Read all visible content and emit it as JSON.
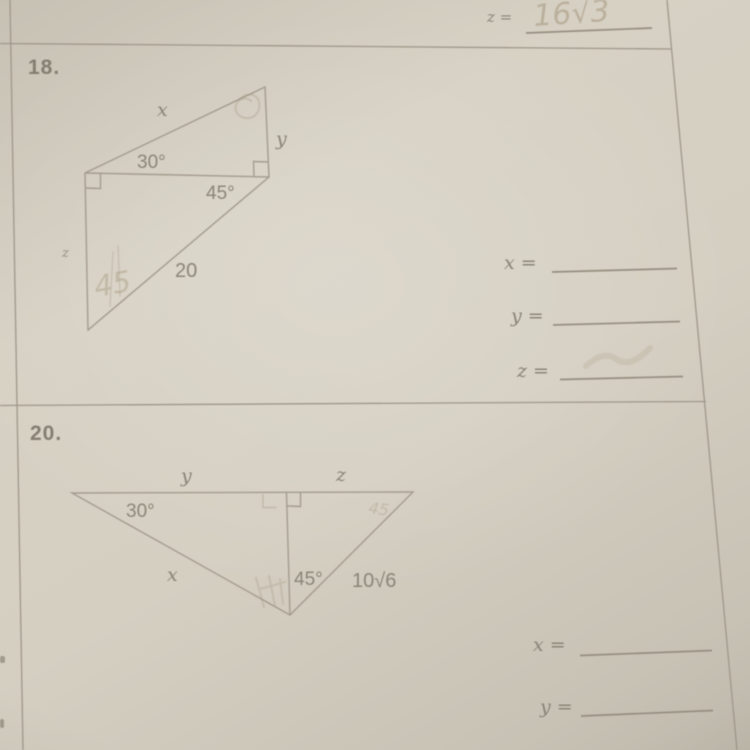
{
  "colors": {
    "paper": "#d5cfc2",
    "rule_line": "#9e978a",
    "figure_line": "#a39c8e",
    "print_text": "#8b8577",
    "pencil": "#a79a82"
  },
  "top_section": {
    "label": "z =",
    "handwritten_answer": "16√3"
  },
  "problem_18": {
    "number": "18.",
    "figure": {
      "side_x": "x",
      "side_y": "y",
      "side_z": "z",
      "hypotenuse_length": "20",
      "angle_upper": "30°",
      "angle_lower": "45°",
      "pencil_note": "45"
    },
    "answers": {
      "x_label": "x =",
      "y_label": "y =",
      "z_label": "z ="
    }
  },
  "problem_20": {
    "number": "20.",
    "figure": {
      "side_top_left": "y",
      "side_top_right": "z",
      "side_lower_left": "x",
      "side_lower_right": "10√6",
      "angle_left": "30°",
      "angle_center": "45°",
      "pencil_note": "45"
    },
    "answers": {
      "x_label": "x =",
      "y_label": "y ="
    }
  }
}
